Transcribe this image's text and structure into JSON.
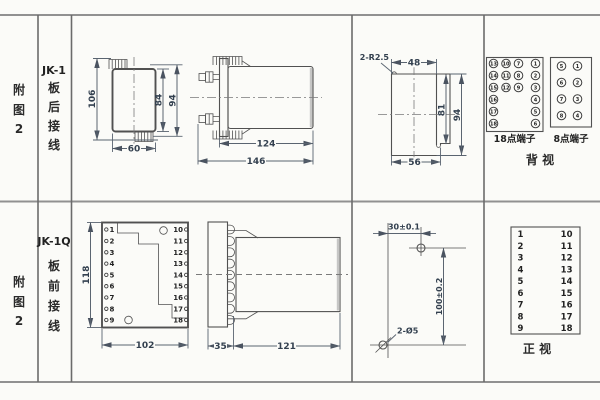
{
  "colors": {
    "background": "#fbfbf8",
    "line": "#515151",
    "grid": "#8a8a8a",
    "dim_text": "#33404f"
  },
  "row_top": {
    "fig": [
      "附",
      "图",
      "2"
    ],
    "model": "JK-1",
    "wiring": [
      "板",
      "后",
      "接",
      "线"
    ],
    "front": {
      "h_total": "106",
      "h_inner": "84",
      "h_outer": "94",
      "width": "60"
    },
    "side": {
      "body": "124",
      "total": "146"
    },
    "cutout": {
      "radius": "2-R2.5",
      "top": "48",
      "inner_h": "81",
      "outer_h": "94",
      "bottom": "56"
    },
    "rear": {
      "t18": {
        "label": "18点端子",
        "grid": [
          [
            "13",
            "10",
            "7",
            "1"
          ],
          [
            "14",
            "11",
            "8",
            "2"
          ],
          [
            "15",
            "12",
            "9",
            "3"
          ]
        ],
        "left": [
          "16",
          "17",
          "18"
        ],
        "right": [
          "4",
          "5",
          "6"
        ]
      },
      "t8": {
        "label": "8点端子",
        "left": [
          "5",
          "6",
          "7",
          "8"
        ],
        "right": [
          "1",
          "2",
          "3",
          "4"
        ]
      },
      "view": "背  视"
    }
  },
  "row_bottom": {
    "fig": [
      "附",
      "图",
      "2"
    ],
    "model": "JK-1Q",
    "wiring": [
      "板",
      "前",
      "接",
      "线"
    ],
    "front": {
      "height": "118",
      "width": "102",
      "left": [
        "1",
        "2",
        "3",
        "4",
        "5",
        "6",
        "7",
        "8",
        "9"
      ],
      "right": [
        "10",
        "11",
        "12",
        "13",
        "14",
        "15",
        "16",
        "17",
        "18"
      ]
    },
    "side": {
      "front_depth": "35",
      "body": "121"
    },
    "drill": {
      "h": "30±0.1",
      "v": "100±0.2",
      "holes": "2-Ø5"
    },
    "table": {
      "left": [
        "1",
        "2",
        "3",
        "4",
        "5",
        "6",
        "7",
        "8",
        "9"
      ],
      "right": [
        "10",
        "11",
        "12",
        "13",
        "14",
        "15",
        "16",
        "17",
        "18"
      ],
      "view": "正  视"
    }
  }
}
